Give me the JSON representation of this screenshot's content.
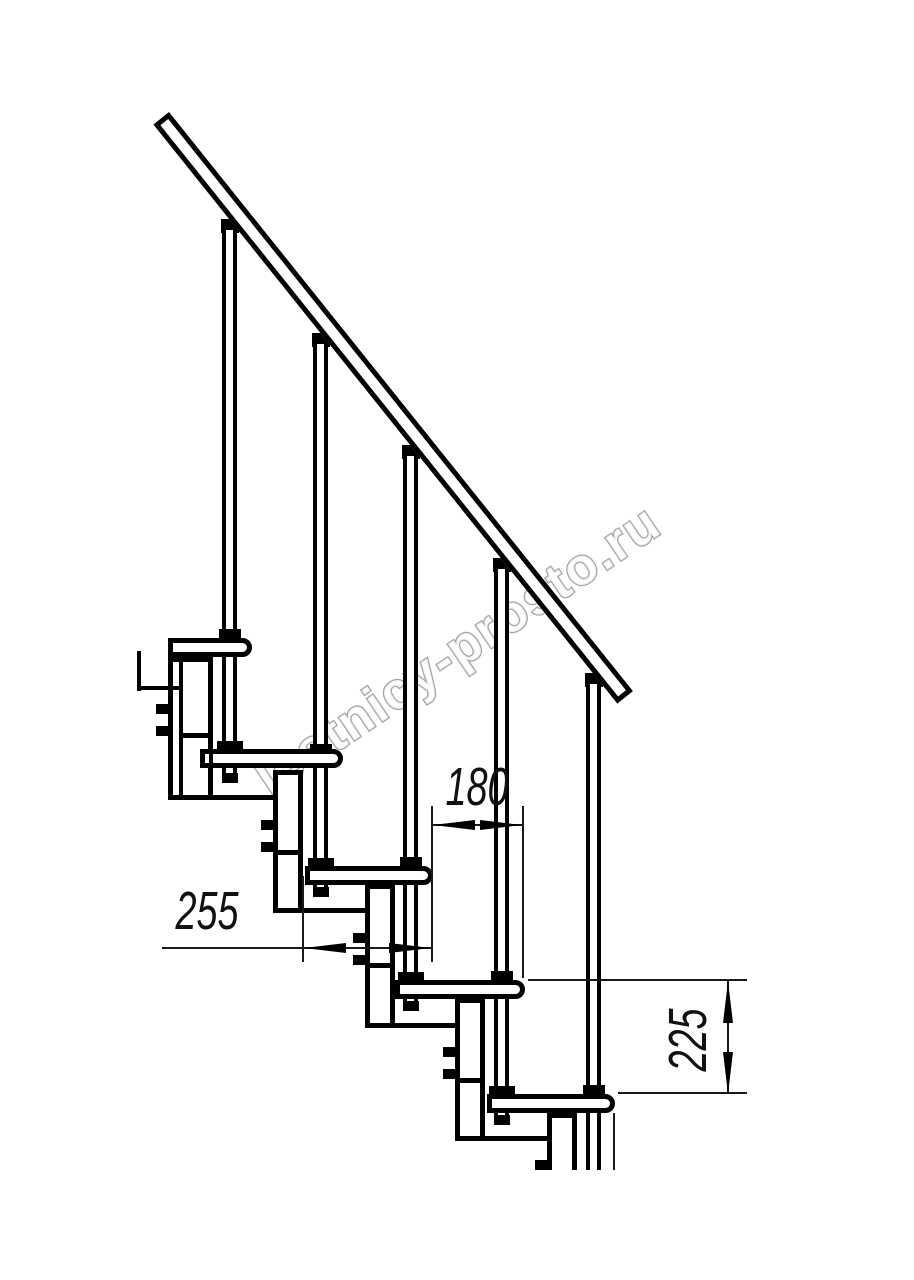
{
  "watermark": {
    "text": "lestnicy-prosto.ru"
  },
  "dimensions": {
    "run": {
      "label": "180"
    },
    "depth": {
      "label": "255"
    },
    "rise": {
      "label": "225"
    }
  }
}
